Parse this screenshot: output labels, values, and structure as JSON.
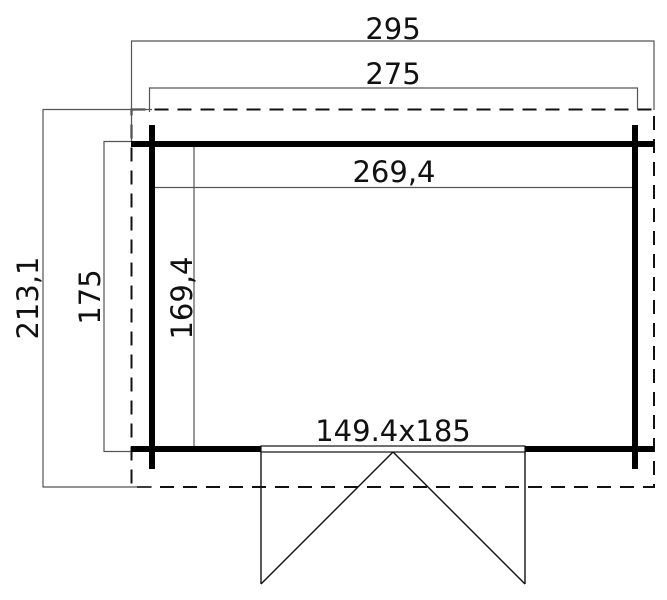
{
  "drawing": {
    "type": "shed-floor-plan",
    "labels": {
      "roof_width": "295",
      "outer_width": "275",
      "inner_width": "269,4",
      "roof_depth": "213,1",
      "outer_depth": "175",
      "inner_depth": "169,4",
      "door_size": "149.4x185"
    },
    "colors": {
      "background": "#ffffff",
      "wall": "#000000",
      "line": "#111111",
      "dimension": "#555555",
      "text": "#111111"
    }
  }
}
